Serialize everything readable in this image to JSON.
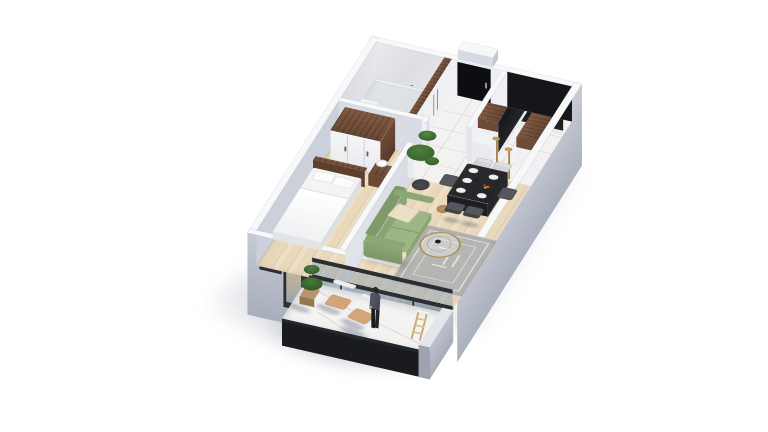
{
  "meta": {
    "title": "3D isometric cutaway floor plan render of a one-bedroom apartment with balcony",
    "view": "axonometric cutaway, white background, soft shadow lower-left",
    "background": "#ffffff"
  },
  "palette": {
    "bg": "#ffffff",
    "wallTop": "#f7f8fa",
    "wallFaceExt": "#b9bdc9",
    "wallFaceInt": "#d6d9e2",
    "walnut": "#6f4a35",
    "kitchenBlack": "#17181c",
    "doorBlack": "#0d0e11",
    "floorWood": "#e9d8ba",
    "floorMarble": "#f3f2f0",
    "bathMarble": "#eef0f1",
    "sofaGreen": "#9cb685",
    "pillowCream": "#ecdfc8",
    "rugGrey": "#b5b6b3",
    "tableDark": "#2c2d31",
    "chairDark": "#55575c",
    "chairLight": "#d3d4d6",
    "gold": "#b3905a",
    "balconyMarble": "#f4f3f1",
    "fascia": "#191b1f",
    "topiaryGreen": "#3c6a30",
    "personJacket": "#4b505e",
    "shadow": "#9aa0ad"
  },
  "rooms": [
    {
      "id": "bathroom",
      "name": "Bathroom",
      "floor": "marble",
      "furniture": [
        "walk-in shower with black fixture",
        "glass partition",
        "vanity",
        "toilet"
      ]
    },
    {
      "id": "hallway",
      "name": "Entry hall",
      "floor": "marble tile",
      "furniture": [
        "black entry door",
        "built-in closets with walnut tops and wood handles"
      ]
    },
    {
      "id": "kitchen",
      "name": "Kitchen",
      "floor": "marble tile",
      "furniture": [
        "U-shaped walnut counter",
        "black tall units",
        "two gold floor lamps"
      ]
    },
    {
      "id": "bedroom",
      "name": "Bedroom",
      "floor": "light wood",
      "furniture": [
        "double bed with white bedding",
        "walnut-top wardrobe",
        "nightstand with lamp"
      ]
    },
    {
      "id": "living",
      "name": "Living / dining room",
      "floor": "light wood",
      "furniture": [
        "sage green sofa with cream pillow",
        "gold round glass coffee table",
        "grey patterned rug",
        "dark dining table with six plates and fruit bowl",
        "six grey chairs",
        "tall potted plant",
        "round side stool",
        "sliding glass wall"
      ]
    },
    {
      "id": "balcony",
      "name": "Balcony",
      "floor": "white marble",
      "furniture": [
        "two white wire chairs with tan cushions",
        "green topiary in pot",
        "standing person figure",
        "small wooden ladder"
      ]
    }
  ],
  "exterior": {
    "walls": "light grey-lavender facades",
    "windows": [
      "small bedroom window",
      "tall bedroom window",
      "full-width sliding glass doors to balcony"
    ],
    "extras": [
      "white rooftop box near entry",
      "dark balcony fascia edge"
    ]
  }
}
